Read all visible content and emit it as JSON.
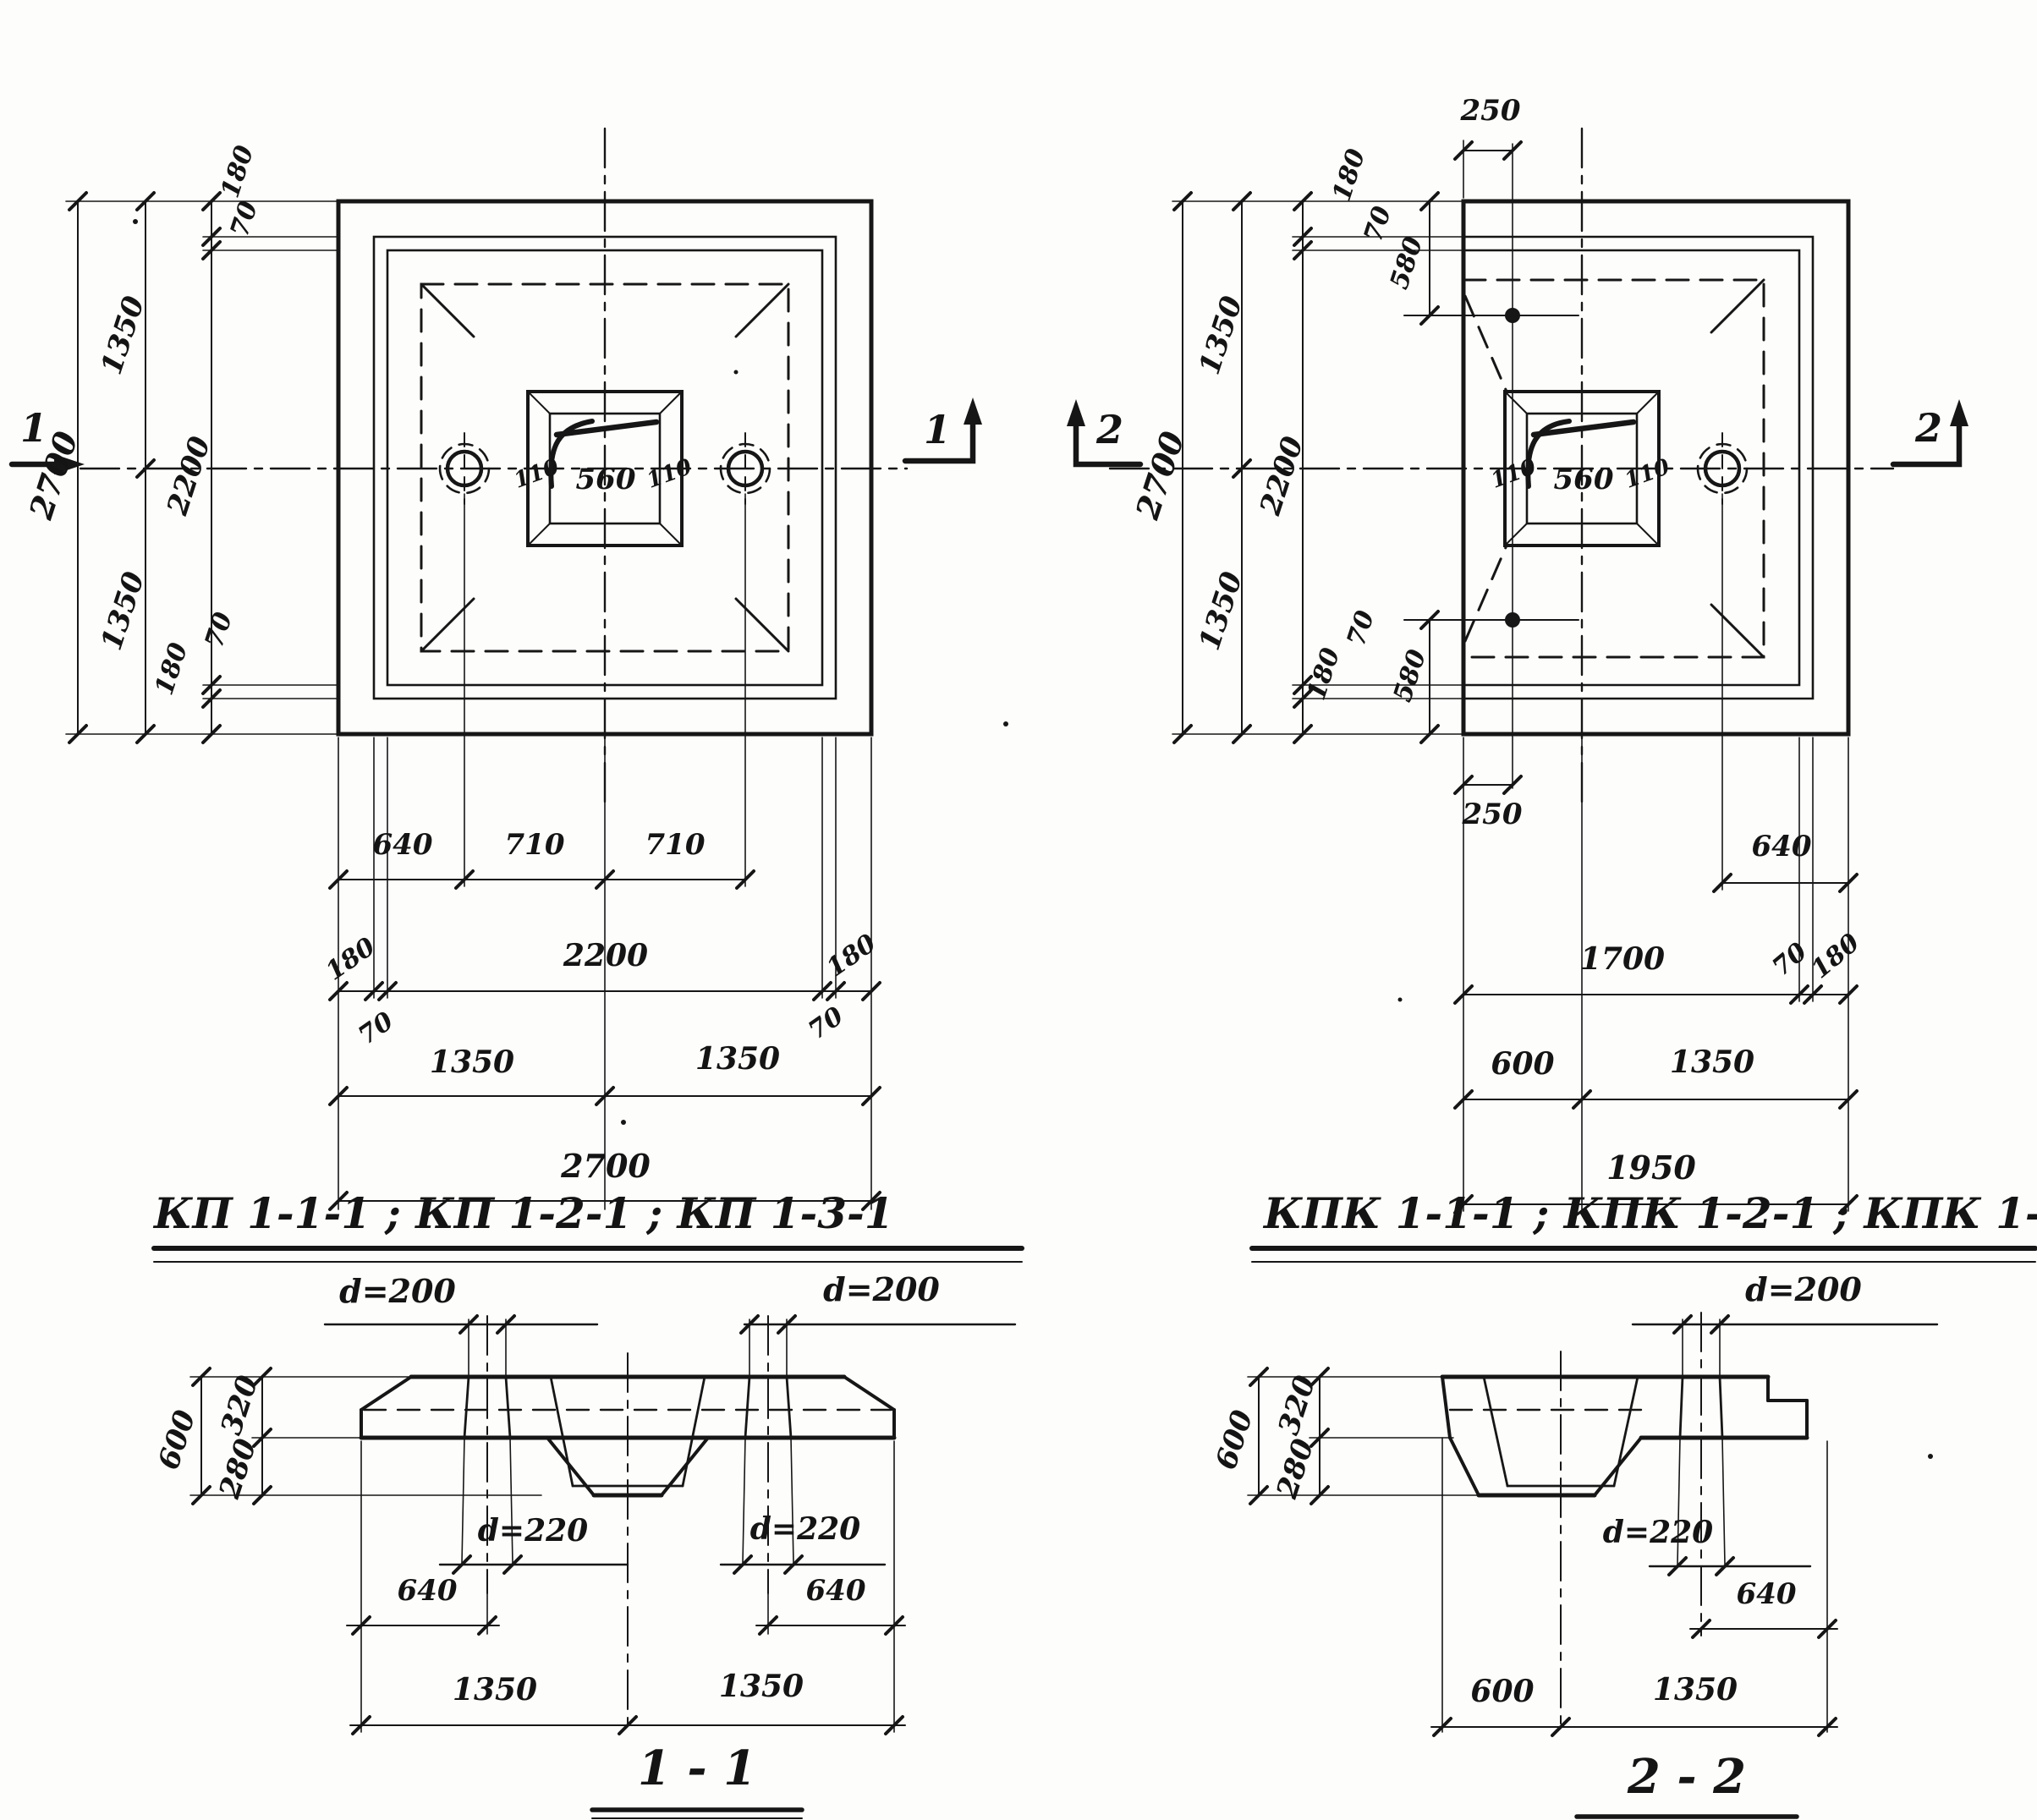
{
  "left_plan": {
    "marker_left": "1",
    "marker_right": "1",
    "dim_2700_v": "2700",
    "dim_1350_vt": "1350",
    "dim_1350_vb": "1350",
    "dim_2200_v": "2200",
    "dim_180_vt": "180",
    "dim_70_vt": "70",
    "dim_70_vb": "70",
    "dim_180_vb": "180",
    "dim_640": "640",
    "dim_710_l": "710",
    "dim_710_r": "710",
    "dim_180_hl": "180",
    "dim_70_hl": "70",
    "dim_2200_h": "2200",
    "dim_70_hr": "70",
    "dim_180_hr": "180",
    "dim_1350_hl": "1350",
    "dim_1350_hr": "1350",
    "dim_2700_h": "2700",
    "cup_110_l": "110",
    "cup_560": "560",
    "cup_110_r": "110"
  },
  "right_plan": {
    "marker_left": "2",
    "marker_right": "2",
    "dim_250_top": "250",
    "dim_250_bot": "250",
    "dim_2700_v": "2700",
    "dim_1350_vt": "1350",
    "dim_1350_vb": "1350",
    "dim_2200_v": "2200",
    "dim_180_vt": "180",
    "dim_70_vt": "70",
    "dim_580_vt": "580",
    "dim_70_vb": "70",
    "dim_580_vb": "580",
    "dim_180_vb": "180",
    "dim_640": "640",
    "dim_1700": "1700",
    "dim_70_h": "70",
    "dim_180_h": "180",
    "dim_600": "600",
    "dim_1350_h": "1350",
    "dim_1950": "1950",
    "cup_110_l": "110",
    "cup_560": "560",
    "cup_110_r": "110"
  },
  "section_1": {
    "title": "КП 1-1-1 ; КП 1-2-1 ; КП 1-3-1",
    "caption": "1 - 1",
    "d200_l": "d=200",
    "d200_r": "d=200",
    "d220_l": "d=220",
    "d220_r": "d=220",
    "dim_600": "600",
    "dim_320": "320",
    "dim_280": "280",
    "dim_640_l": "640",
    "dim_640_r": "640",
    "dim_1350_l": "1350",
    "dim_1350_r": "1350"
  },
  "section_2": {
    "title": "КПК 1-1-1 ; КПК 1-2-1 ; КПК 1-3-1",
    "caption": "2 - 2",
    "d200": "d=200",
    "d220": "d=220",
    "dim_600_v": "600",
    "dim_320": "320",
    "dim_280": "280",
    "dim_640": "640",
    "dim_600_h": "600",
    "dim_1350": "1350"
  }
}
